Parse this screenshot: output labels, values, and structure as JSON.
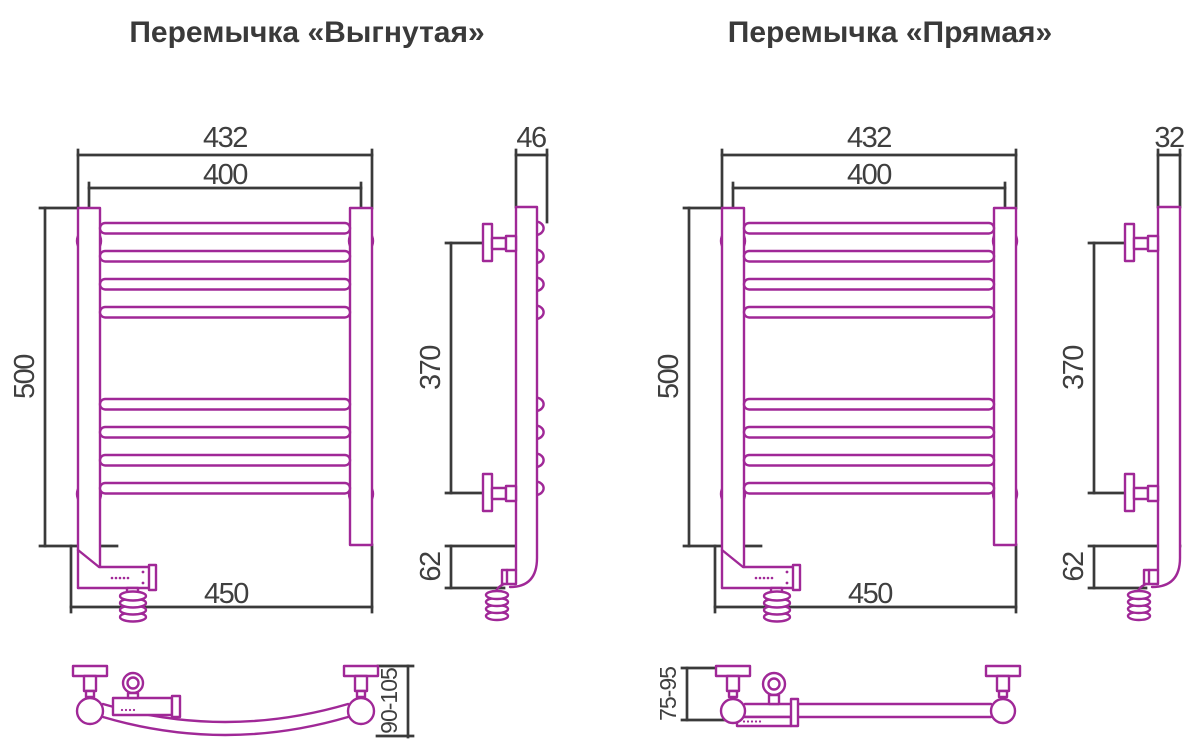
{
  "colors": {
    "product_line": "#a02897",
    "dimension_line": "#3a3a3a",
    "text": "#3f3f3f",
    "background": "#ffffff"
  },
  "left_drawing": {
    "title": "Перемычка «Выгнутая»",
    "front_view": {
      "overall_width": "432",
      "axis_width": "400",
      "height": "500",
      "bottom_width": "450"
    },
    "side_view": {
      "depth": "46",
      "mount_spacing": "370",
      "bottom_offset": "62"
    },
    "top_view": {
      "wall_clearance": "90-105"
    }
  },
  "right_drawing": {
    "title": "Перемычка «Прямая»",
    "front_view": {
      "overall_width": "432",
      "axis_width": "400",
      "height": "500",
      "bottom_width": "450"
    },
    "side_view": {
      "depth": "32",
      "mount_spacing": "370",
      "bottom_offset": "62"
    },
    "top_view": {
      "wall_clearance": "75-95"
    }
  }
}
